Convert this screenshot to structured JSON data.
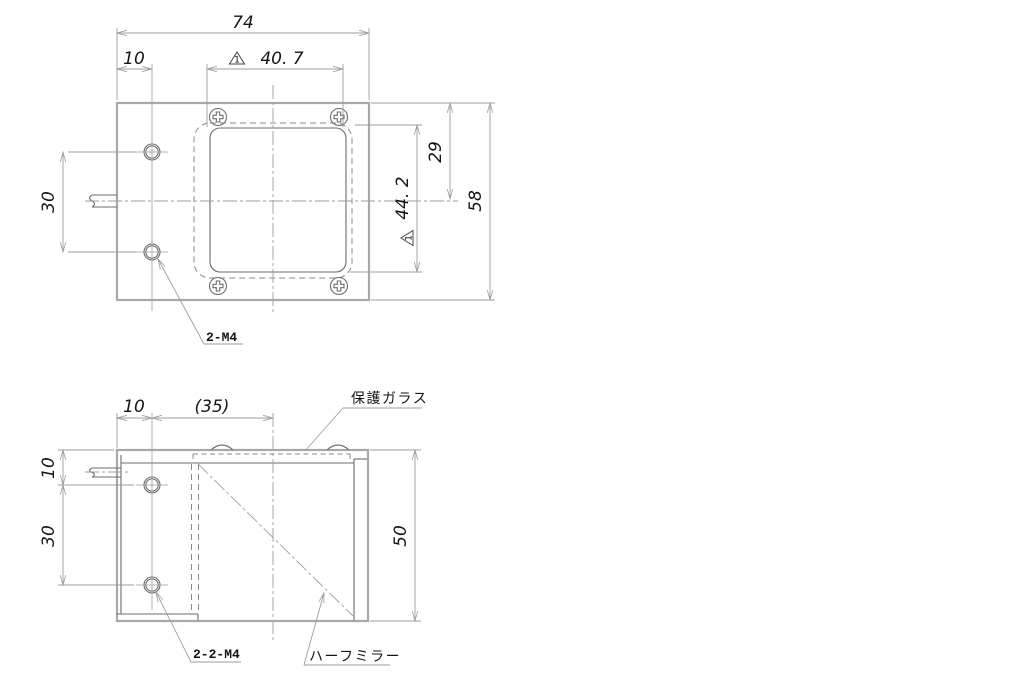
{
  "drawing": {
    "colors": {
      "outline": "#a8a8a8",
      "object_line": "#6d6d6d",
      "dimension_line": "#9e9e9e",
      "text": "#141414",
      "background": "#ffffff"
    },
    "top_view": {
      "dim_overall_width": "74",
      "dim_hole_offset": "10",
      "rev_mark_width": "1",
      "dim_window_width": "40. 7",
      "dim_top_to_center": "29",
      "rev_mark_height": "1",
      "dim_window_height": "44. 2",
      "dim_overall_height": "58",
      "dim_hole_pitch": "30",
      "label_holes": "2-M4"
    },
    "side_view": {
      "dim_hole_offset": "10",
      "dim_center_offset": "(35)",
      "dim_top_to_hole": "10",
      "dim_hole_pitch": "30",
      "dim_overall_height": "50",
      "label_holes": "2-2-M4",
      "label_protective_glass": "保護ガラス",
      "label_half_mirror": "ハーフミラー"
    }
  }
}
